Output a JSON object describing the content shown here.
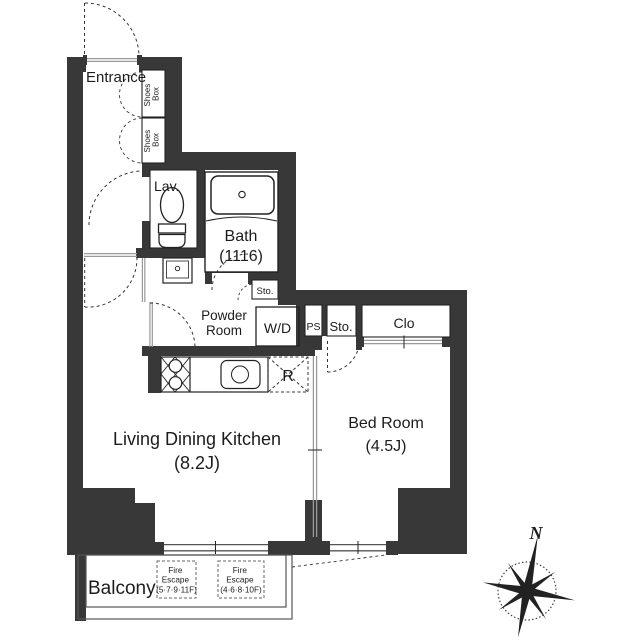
{
  "plan": {
    "rooms": {
      "entrance": "Entrance",
      "lavatory": "Lav.",
      "bath": "Bath",
      "bath_size": "(1116)",
      "powder_line1": "Powder",
      "powder_line2": "Room",
      "ldk": "Living Dining Kitchen",
      "ldk_size": "(8.2J)",
      "bedroom": "Bed Room",
      "bedroom_size": "(4.5J)",
      "balcony": "Balcony",
      "closet": "Clo",
      "storage_hall": "Sto.",
      "storage_bath": "Sto.",
      "pipe_space": "PS"
    },
    "fixtures": {
      "washer_dryer": "W/D",
      "refrigerator": "R"
    },
    "shoes_boxes": [
      {
        "line1": "Shoes",
        "line2": "Box"
      },
      {
        "line1": "Shoes",
        "line2": "Box"
      }
    ],
    "fire_escape_1": {
      "line1": "Fire",
      "line2": "Escape",
      "line3": "(5·7·9·11F)"
    },
    "fire_escape_2": {
      "line1": "Fire",
      "line2": "Escape",
      "line3": "(4·6·8·10F)"
    },
    "compass": {
      "north": "N"
    }
  },
  "colors": {
    "wall": "#383838",
    "line": "#1c1c1c",
    "door_line": "#9a9a9a",
    "background": "#ffffff"
  }
}
